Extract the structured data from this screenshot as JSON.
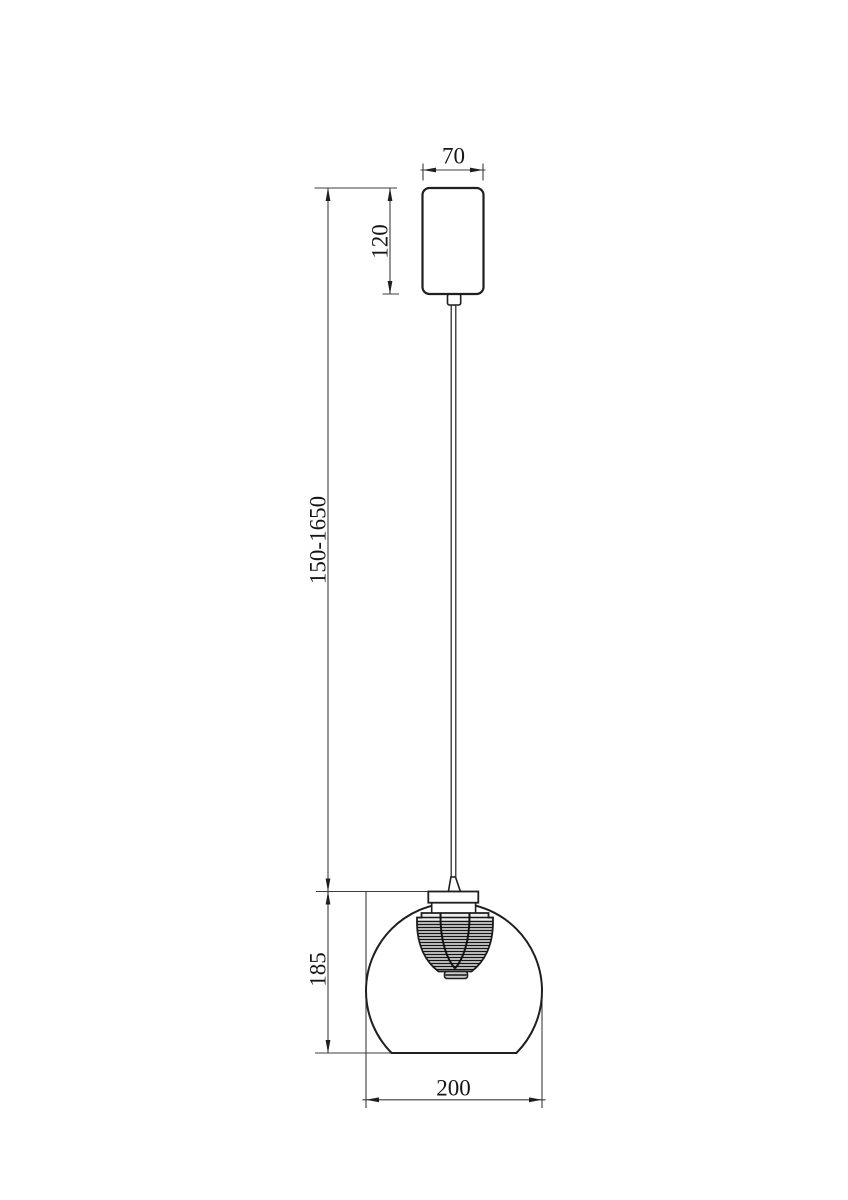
{
  "drawing": {
    "dimensions": {
      "canopy_width_mm": "70",
      "canopy_height_mm": "120",
      "suspension_range_mm": "150-1650",
      "shade_height_mm": "185",
      "shade_width_mm": "200"
    },
    "colors": {
      "background": "#ffffff",
      "object_line": "#1f1f1f",
      "dimension_line": "#3d3d3d",
      "text": "#161616",
      "diffuser_fill": "#ededed"
    }
  }
}
